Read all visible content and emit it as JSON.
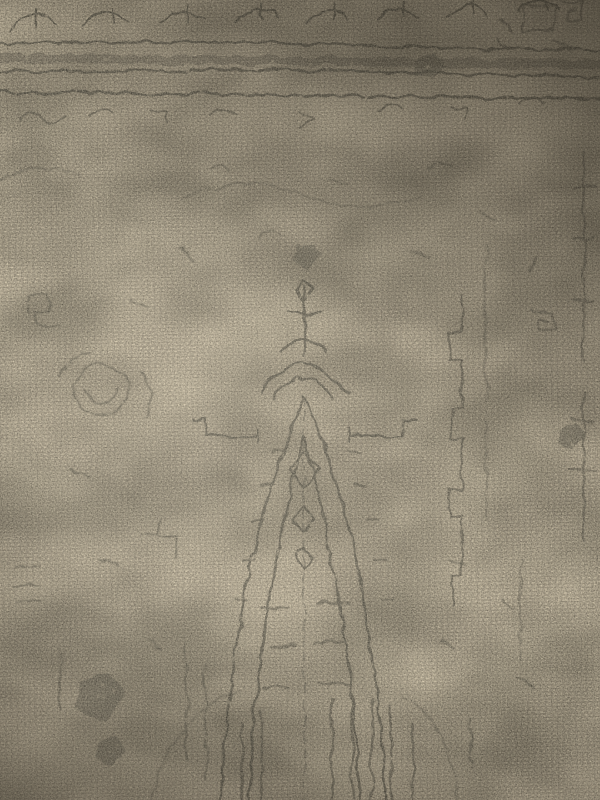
{
  "scene": {
    "type": "photograph",
    "subject": "vintage distressed oriental rug seen from above, close-up",
    "alt": "Faded gray-on-beige vintage oriental rug texture",
    "description": "Overhead close-up photograph of a worn vintage-style area rug: a faded charcoal medallion pattern printed on a beige basket-weave textile. A horizontal border band with scrollwork crosses near the top, a distressed pointed-arch medallion column runs down the center, small rosettes and geometric motifs are scattered in the field, broken vertical stripes fill the bottom center, and the lighting falls off into shadow toward the top-right corner.",
    "elements": {
      "border_band": "horizontal double-line border with dashed filling and scroll motifs near top",
      "medallion": "central pointed-arch medallion column with nested diamonds and ladder bars",
      "rosette": "faded circular rosette motif on the left side",
      "meander": "right-angle meander line on the right side",
      "stripes": "broken vertical stripes at bottom center",
      "blobs": "dark eroded print blotches lower-left and upper-right"
    }
  },
  "palette": {
    "base": "#b0a591",
    "weaveLight": "#d9ccb0",
    "weaveMid": "#bdb19a",
    "weaveShadow": "#867c6a",
    "ink": "#3d3c34",
    "inkSoft": "#5c594c",
    "cornerShade": "#27221a",
    "highlight": "#fdf4df"
  },
  "lighting": {
    "brightest": "center-left",
    "darkest": "top-right corner",
    "quality": "soft indoor light, slight vignette"
  }
}
